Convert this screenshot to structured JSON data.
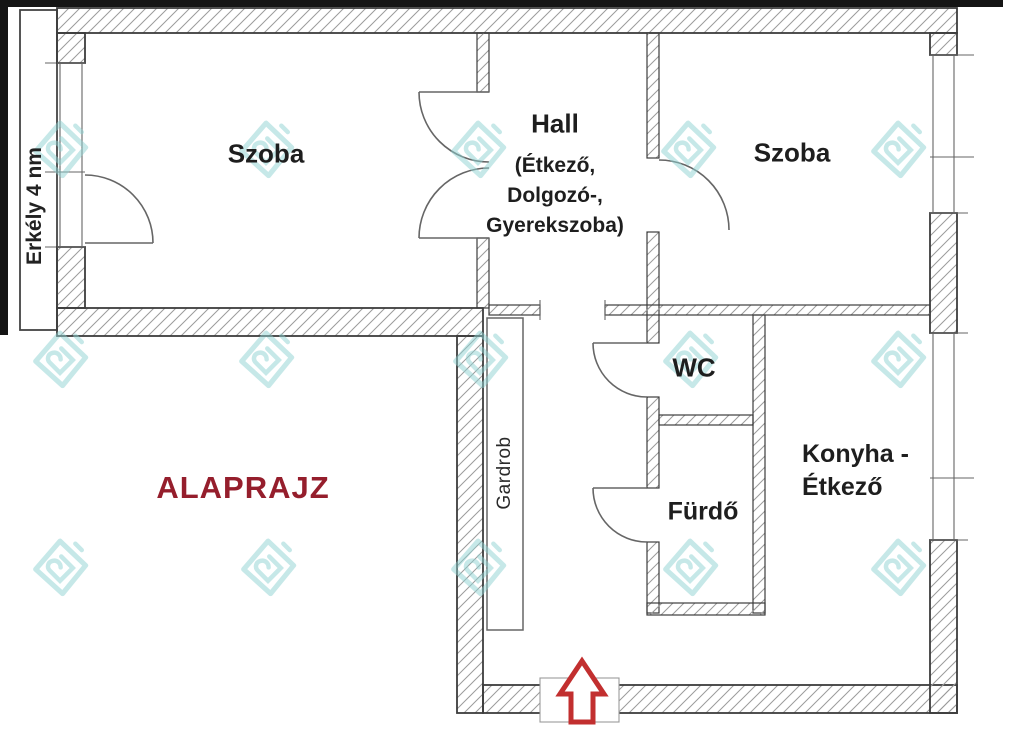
{
  "document_type": "apartment-floor-plan",
  "title": {
    "text": "ALAPRAJZ"
  },
  "rooms": {
    "szoba_left": "Szoba",
    "hall": "Hall",
    "hall_sub": [
      "(Étkező,",
      "Dolgozó-,",
      "Gyerekszoba)"
    ],
    "szoba_right": "Szoba",
    "wc": "WC",
    "furdo": "Fürdő",
    "konyha_line1": "Konyha -",
    "konyha_line2": "Étkező",
    "gardrob": "Gardrob",
    "erkely": "Erkély 4 nm"
  },
  "icons": {
    "entrance_arrow": "up-block-arrow",
    "watermark": "aj-diamond-logo"
  },
  "colors": {
    "title_red": "#951e2c",
    "arrow_red": "#c22f2f",
    "watermark_teal": "#8fd2d2",
    "wall_line": "#3c3c3c",
    "hatch_line": "#9b9b9b",
    "door_line": "#666666",
    "frame_black": "#151515"
  }
}
